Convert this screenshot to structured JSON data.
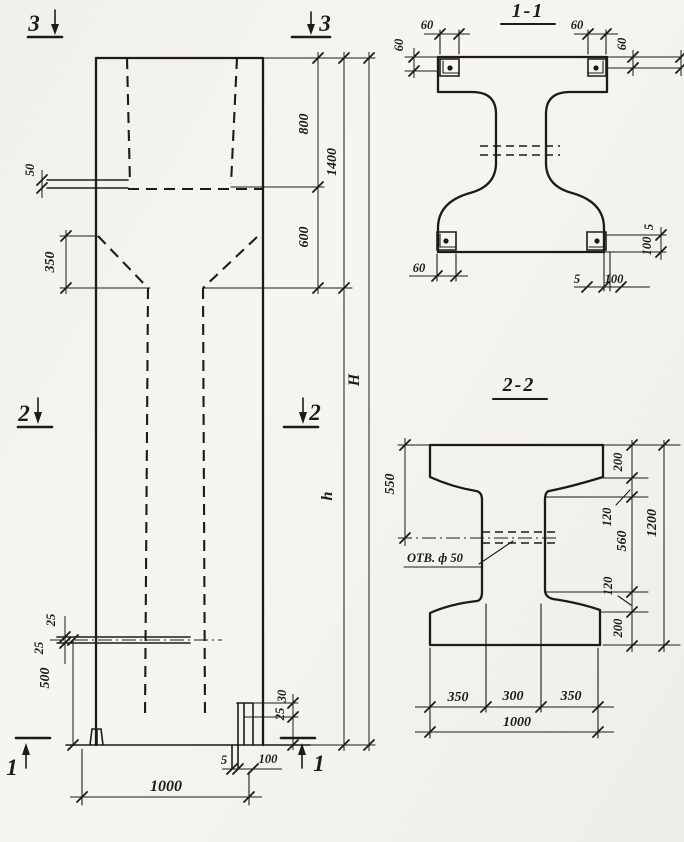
{
  "colors": {
    "paper": "#f7f5ef",
    "ink": "#1d1b17"
  },
  "elevation": {
    "markers": {
      "top_left": "3",
      "top_right": "3",
      "mid_left": "2",
      "mid_right": "2",
      "bottom_left": "1",
      "bottom_right": "1"
    },
    "dims": {
      "fifty": "50",
      "threefifty": "350",
      "twentyfive_upper": "25",
      "twentyfive_lower": "25",
      "fivehundred": "500",
      "eighthundred": "800",
      "sixhundred": "600",
      "fourteenhundred": "1400",
      "height_total": "H",
      "height_lower": "h",
      "thousand": "1000",
      "shoe_five": "5",
      "shoe_hundred": "100",
      "shoe_thirty": "30",
      "shoe_twentyfive": "25"
    }
  },
  "section11": {
    "title": "1-1",
    "dims": {
      "top_left_width": "60",
      "top_left_height": "60",
      "top_right_width": "60",
      "top_right_height": "60",
      "bottom_left_width": "60",
      "bottom_right_5": "5",
      "bottom_right_100": "100",
      "bottom_right_v5": "5",
      "bottom_right_v100": "100"
    }
  },
  "section22": {
    "title": "2-2",
    "hole_label": "ОТВ. ф 50",
    "dims": {
      "d550": "550",
      "d200_top": "200",
      "d120_top": "120",
      "d560": "560",
      "d120_bot": "120",
      "d200_bot": "200",
      "d1200": "1200",
      "d350_left": "350",
      "d300": "300",
      "d350_right": "350",
      "d1000": "1000"
    }
  }
}
